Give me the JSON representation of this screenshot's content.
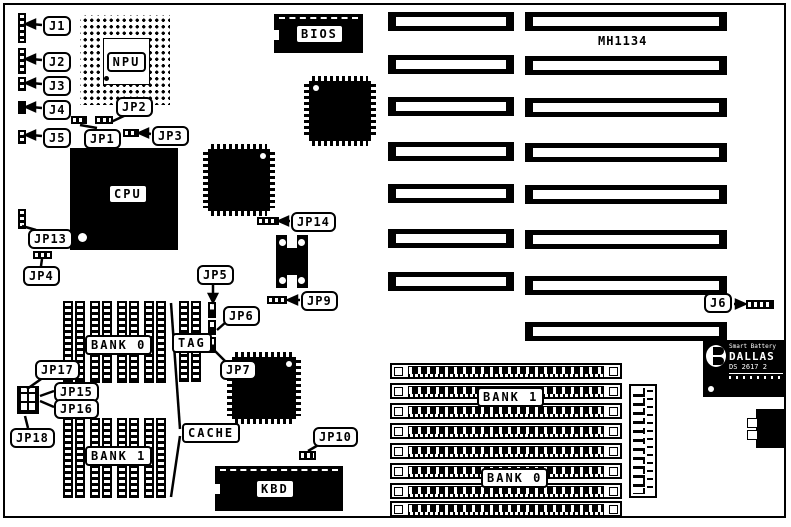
{
  "board": {
    "model": "MH1134",
    "ink": "#000000",
    "paper": "#ffffff"
  },
  "chips": {
    "npu": "NPU",
    "cpu": "CPU",
    "bios": "BIOS",
    "kbd": "KBD"
  },
  "memory": {
    "cache_bank0": "BANK 0",
    "cache_bank1": "BANK 1",
    "tag": "TAG",
    "cache": "CACHE",
    "simm_bank1": "BANK 1",
    "simm_bank0": "BANK 0",
    "simm_rows": 8,
    "cache_socket_pairs_per_bank": 4,
    "tag_socket_pairs": 1
  },
  "expansion_slots": {
    "left_column": 7,
    "right_column": 8
  },
  "callouts": {
    "j1": "J1",
    "j2": "J2",
    "j3": "J3",
    "j4": "J4",
    "j5": "J5",
    "j6": "J6",
    "jp1": "JP1",
    "jp2": "JP2",
    "jp3": "JP3",
    "jp4": "JP4",
    "jp5": "JP5",
    "jp6": "JP6",
    "jp7": "JP7",
    "jp9": "JP9",
    "jp10": "JP10",
    "jp13": "JP13",
    "jp14": "JP14",
    "jp15": "JP15",
    "jp16": "JP16",
    "jp17": "JP17",
    "jp18": "JP18"
  },
  "rtc_module": {
    "line1": "Smart Battery",
    "line2": "DALLAS",
    "line3": "DS 2617 2"
  }
}
